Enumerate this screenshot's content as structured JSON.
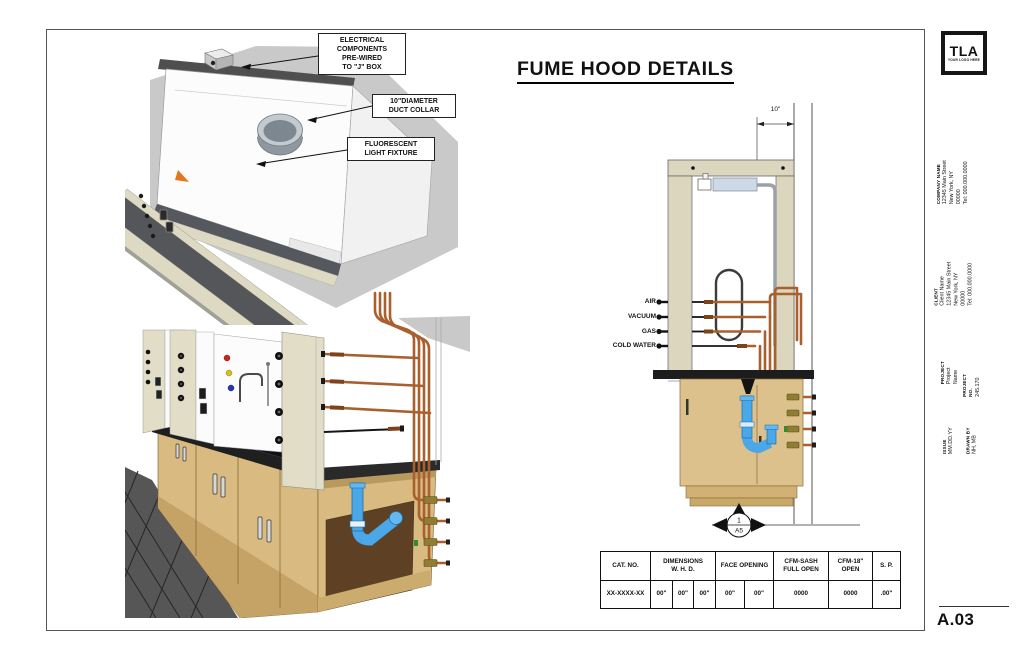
{
  "sheet": {
    "title": "FUME HOOD DETAILS",
    "number": "A.03"
  },
  "logo": {
    "text": "TLA",
    "tagline": "YOUR LOGO HERE"
  },
  "title_block": {
    "company": {
      "label": "COMPANY NAME",
      "lines": "12345 Main Street\nNew York, NY 00000\nTel: 000.000.0000"
    },
    "client": {
      "label": "CLIENT",
      "lines": "Client Name\n12345 Main Street\nNew York, NY 00000\nTel: 000.000.0000"
    },
    "project": {
      "label": "PROJECT",
      "value": "Project Name"
    },
    "project_no": {
      "label": "PROJECT NO.",
      "value": "245.170"
    },
    "issue": {
      "label": "ISSUE",
      "value": "MM.DD.YY"
    },
    "drawn_by": {
      "label": "DRAWN BY",
      "value": "NH, MB"
    }
  },
  "callouts": {
    "electrical": "ELECTRICAL\nCOMPONENTS\nPRE-WIRED\nTO \"J\" BOX",
    "duct": "10\"DIAMETER\nDUCT COLLAR",
    "light": "FLUORESCENT\nLIGHT FIXTURE"
  },
  "elevation": {
    "dimension": "10\"",
    "services": [
      "AIR",
      "VACUUM",
      "GAS",
      "COLD WATER"
    ],
    "callout": {
      "number": "1",
      "sheet": "A5"
    }
  },
  "table": {
    "headers": [
      "CAT. NO.",
      "DIMENSIONS\nW. H. D.",
      "FACE OPENING",
      "CFM-SASH\nFULL OPEN",
      "CFM-18\"\nOPEN",
      "S. P."
    ],
    "row": [
      "XX-XXXX-XX",
      "00\"",
      "00\"",
      "00\"",
      "00\"",
      "00\"",
      "0000",
      "0000",
      ".00\""
    ]
  },
  "colors": {
    "copper": "#a9602f",
    "brass": "#8e7d33",
    "blue_pipe": "#4aa7e8",
    "beige": "#dbd6bd",
    "wood": "#d9ba80",
    "counter": "#1d1d1d",
    "backdrop_gray": "#c9c9c9"
  }
}
